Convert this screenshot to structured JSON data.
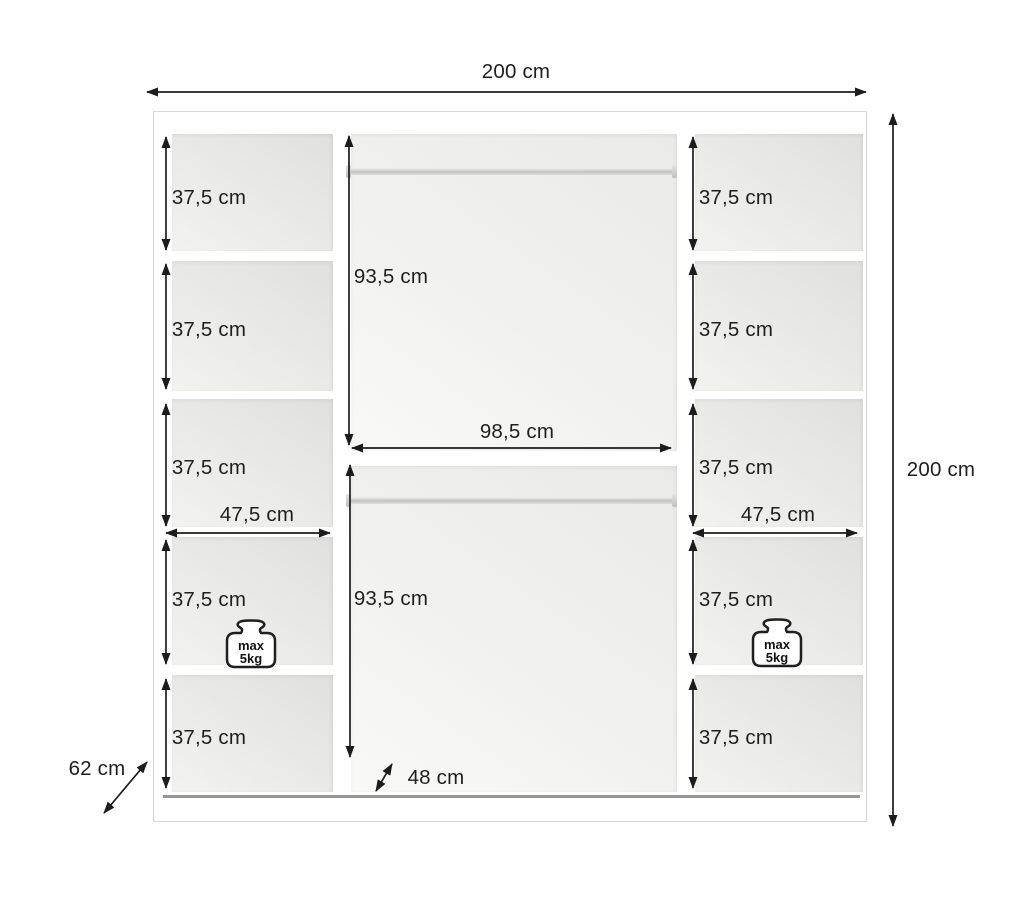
{
  "diagram": {
    "overall": {
      "width_label": "200 cm",
      "height_label": "200 cm",
      "depth_label": "62 cm"
    },
    "middle_section": {
      "width_label": "98,5 cm",
      "upper_hanging_height_label": "93,5 cm",
      "lower_hanging_height_label": "93,5 cm",
      "interior_depth_label": "48 cm"
    },
    "left_column": {
      "width_label": "47,5 cm",
      "shelf_height_labels": [
        "37,5 cm",
        "37,5 cm",
        "37,5 cm",
        "37,5 cm",
        "37,5 cm"
      ]
    },
    "right_column": {
      "width_label": "47,5 cm",
      "shelf_height_labels": [
        "37,5 cm",
        "37,5 cm",
        "37,5 cm",
        "37,5 cm",
        "37,5 cm"
      ]
    },
    "weight_limit": {
      "line1": "max",
      "line2": "5kg"
    },
    "colors": {
      "dimension_line": "#1c1c1c",
      "cell_shade": "#e6e6e4",
      "floor_line": "#979795"
    }
  }
}
